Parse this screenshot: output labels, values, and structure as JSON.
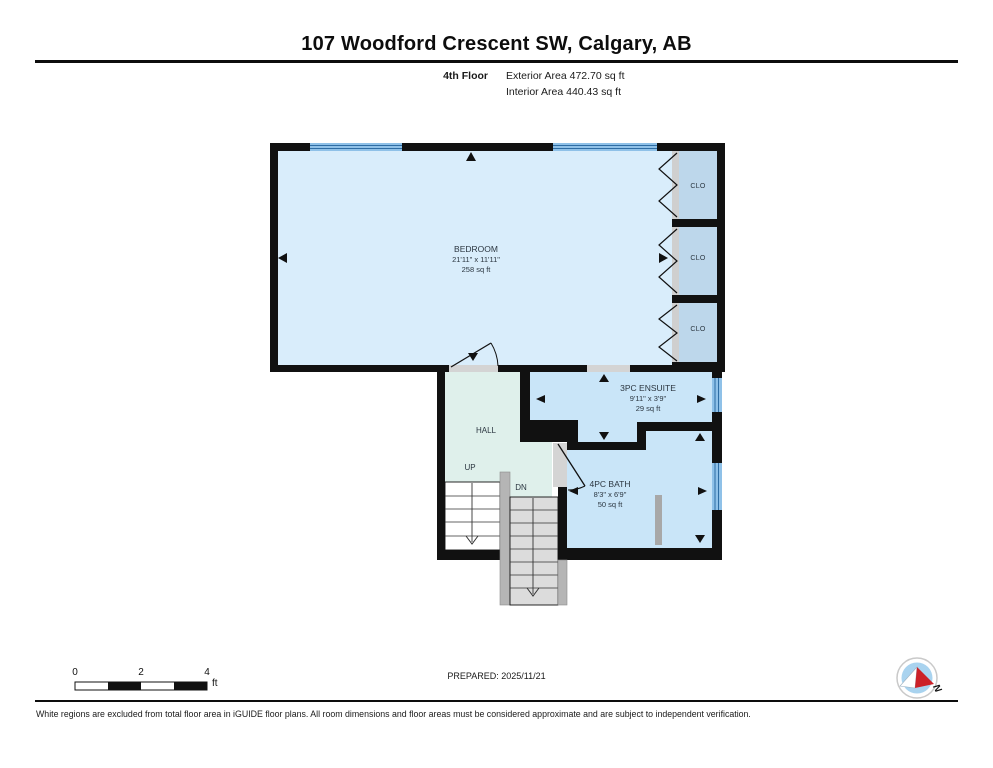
{
  "header": {
    "title": "107 Woodford Crescent SW, Calgary, AB",
    "floor_label": "4th Floor",
    "exterior_area": "Exterior Area 472.70 sq ft",
    "interior_area": "Interior Area 440.43 sq ft"
  },
  "rooms": {
    "bedroom": {
      "name": "BEDROOM",
      "dimensions": "21'11\" x 11'11\"",
      "area": "258 sq ft"
    },
    "ensuite": {
      "name": "3PC ENSUITE",
      "dimensions": "9'11\" x 3'9\"",
      "area": "29 sq ft"
    },
    "bath": {
      "name": "4PC BATH",
      "dimensions": "8'3\" x 6'9\"",
      "area": "50 sq ft"
    },
    "hall": {
      "name": "HALL"
    },
    "closet_top": {
      "name": "CLO"
    },
    "closet_middle": {
      "name": "CLO"
    },
    "closet_bottom": {
      "name": "CLO"
    }
  },
  "stairs": {
    "up_label": "UP",
    "down_label": "DN"
  },
  "scale_bar": {
    "tick_0": "0",
    "tick_2": "2",
    "tick_4": "4",
    "unit": "ft"
  },
  "compass": {
    "north_label": "N"
  },
  "footer": {
    "prepared": "PREPARED: 2025/11/21",
    "disclaimer": "White regions are excluded from total floor area in iGUIDE floor plans. All room dimensions and floor areas must be considered approximate and are subject to independent verification."
  },
  "colors": {
    "wall": "#111111",
    "bedroom_floor": "#d9edfb",
    "bathroom_floor": "#c9e5f8",
    "closet_floor": "#bdd7eb",
    "hall_floor": "#dff0eb",
    "window_glass": "#8fc1e8",
    "window_stripe": "#2e6da4",
    "threshold_gray": "#d4d4d4",
    "stair_gray": "#dcdcdc",
    "rail_gray": "#b5b5b5",
    "compass_red": "#cc2027",
    "compass_blue": "#a9d3ef"
  }
}
